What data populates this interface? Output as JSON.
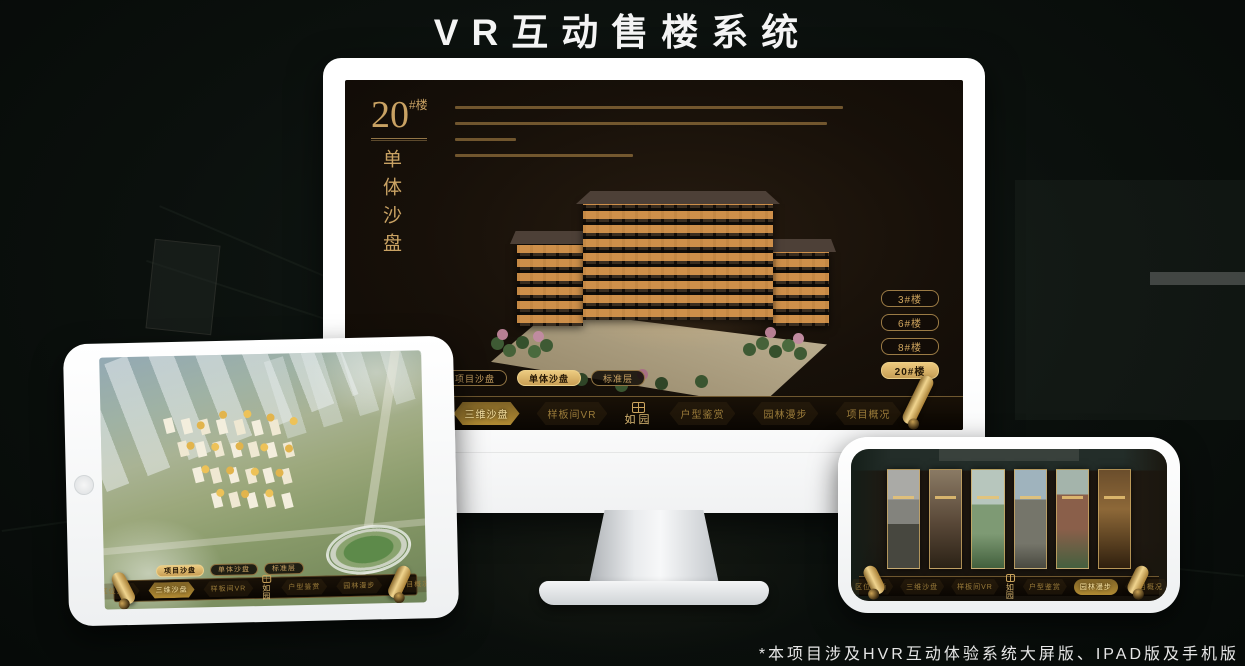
{
  "header": {
    "title": "VR互动售楼系统"
  },
  "footer": {
    "note": "*本项目涉及HVR互动体验系统大屏版、IPAD版及手机版"
  },
  "colors": {
    "gold": "#c9a263",
    "gold_active": "#e3c078",
    "screen_bg": "#15100b",
    "page_bg": "#0a0f0c"
  },
  "monitor": {
    "title_number": "20",
    "title_suffix": "#楼",
    "title_vertical": "单体沙盘",
    "floor_buttons": [
      {
        "label": "3#楼",
        "active": false
      },
      {
        "label": "6#楼",
        "active": false
      },
      {
        "label": "8#楼",
        "active": false
      },
      {
        "label": "20#楼",
        "active": true
      }
    ],
    "tabs": [
      {
        "label": "项目沙盘",
        "active": false
      },
      {
        "label": "单体沙盘",
        "active": true
      },
      {
        "label": "标准层",
        "active": false
      }
    ],
    "nav": {
      "items": [
        "区位交通",
        "三维沙盘",
        "样板间VR",
        "户型鉴赏",
        "园林漫步",
        "项目概况"
      ],
      "active_item": "三维沙盘",
      "logo": "如园"
    }
  },
  "tablet": {
    "tabs": [
      {
        "label": "项目沙盘",
        "active": true
      },
      {
        "label": "单体沙盘",
        "active": false
      },
      {
        "label": "标准层",
        "active": false
      }
    ],
    "nav": {
      "items": [
        "区位交通",
        "三维沙盘",
        "样板间VR",
        "户型鉴赏",
        "园林漫步",
        "项目概况"
      ],
      "active_item": "三维沙盘",
      "logo": "如园"
    }
  },
  "phone": {
    "nav": {
      "items": [
        "区位交通",
        "三维沙盘",
        "样板间VR",
        "户型鉴赏",
        "园林漫步",
        "项目概况"
      ],
      "active_item": "园林漫步",
      "logo": "如园"
    }
  }
}
